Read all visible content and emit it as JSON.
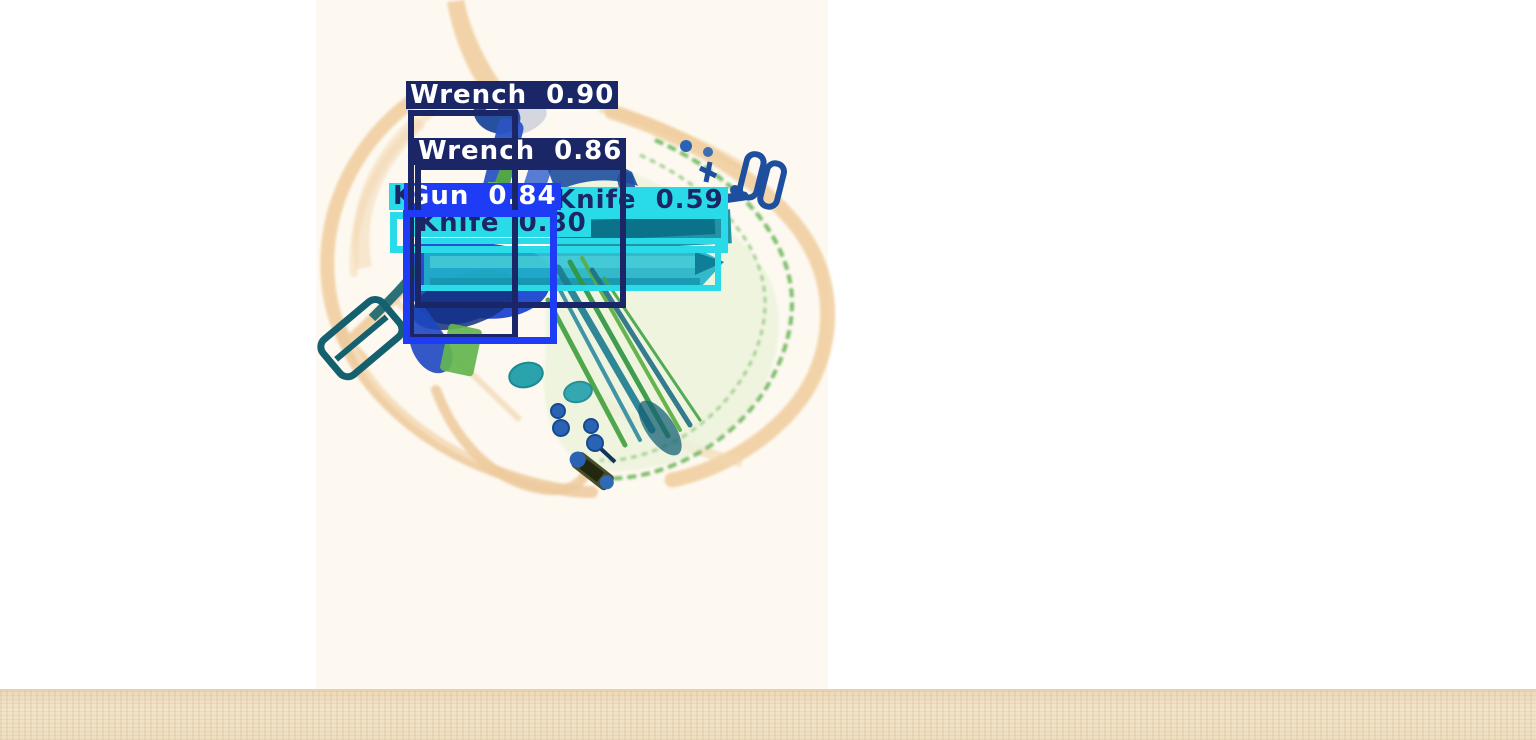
{
  "image": {
    "kind": "x-ray-baggage-scan-with-detections",
    "background_color": "#ffffff",
    "belt_color": "#efdfc2"
  },
  "colors": {
    "navy_box": "#1a2666",
    "blue_box": "#1e3cf5",
    "cyan_box": "#29dbe8",
    "label_text_light": "#ffffff",
    "label_text_dark": "#1a2666"
  },
  "detections": [
    {
      "object": "Wrench",
      "score": "0.90",
      "display": "Wrench 0.90",
      "box_color": "#1a2666",
      "text_color": "#ffffff"
    },
    {
      "object": "Wrench",
      "score": "0.86",
      "display": "Wrench 0.86",
      "box_color": "#1a2666",
      "text_color": "#ffffff"
    },
    {
      "object": "Gun",
      "score": "0.84",
      "display": "Gun 0.84",
      "box_color": "#1e3cf5",
      "text_color": "#ffffff"
    },
    {
      "object": "Knife",
      "score": "0.80",
      "display": "Knife 0.80",
      "box_color": "#29dbe8",
      "text_color": "#1a2666"
    },
    {
      "object": "Knife",
      "score": "0.59",
      "display": "Knife 0.59",
      "box_color": "#29dbe8",
      "text_color": "#1a2666"
    },
    {
      "object": "Knife",
      "score": "",
      "display": "K",
      "box_color": "#29dbe8",
      "text_color": "#1a2666",
      "occluded": true
    }
  ]
}
